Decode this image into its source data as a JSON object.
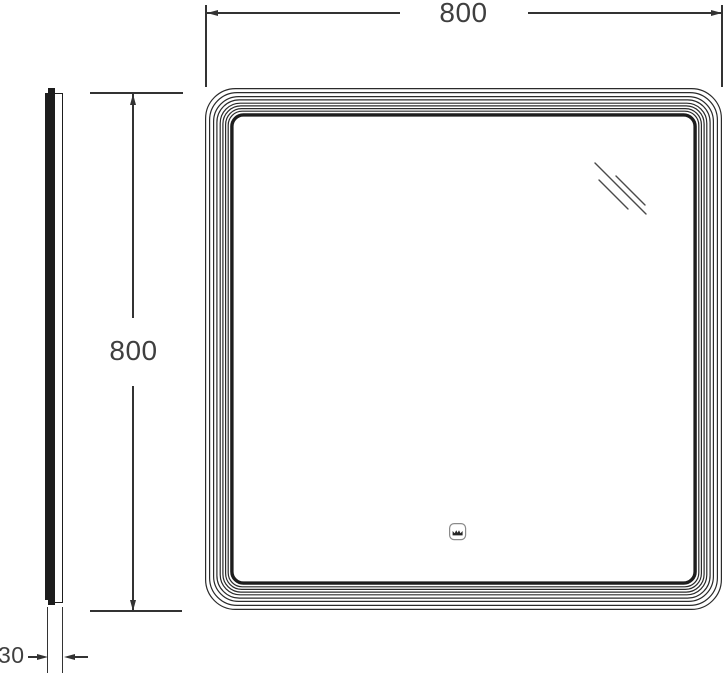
{
  "drawing": {
    "type": "technical-dimension-drawing",
    "views": {
      "front": "mirror front view",
      "side": "mirror side profile"
    },
    "dimensions": {
      "width": {
        "label": "800"
      },
      "height": {
        "label": "800"
      },
      "depth": {
        "label": "30"
      }
    },
    "icons": {
      "sensor": "touch-sensor-icon",
      "reflection": "glass-reflection-marks"
    },
    "colors": {
      "line": "#2a2a2a",
      "dim_line": "#333333",
      "text": "#3f3f3f",
      "background": "#ffffff",
      "sensor_stroke": "#8a8a8a",
      "reflection_stroke": "#4a4a4a"
    },
    "frame": {
      "thin_insets": [
        0,
        4,
        8,
        11.3,
        14.6,
        17.3,
        20,
        22.6
      ],
      "thin_radii": [
        30,
        27.5,
        25,
        22.5,
        20,
        18,
        16,
        14
      ],
      "thin_stroke": 1.2,
      "thick_inset": 25.2,
      "thick_stroke": 3.4,
      "thick_radius": 11.5
    },
    "reflection_lines": [
      [
        390,
        75,
        441,
        126
      ],
      [
        394,
        92,
        423,
        121
      ],
      [
        411,
        88,
        440,
        117
      ]
    ]
  }
}
